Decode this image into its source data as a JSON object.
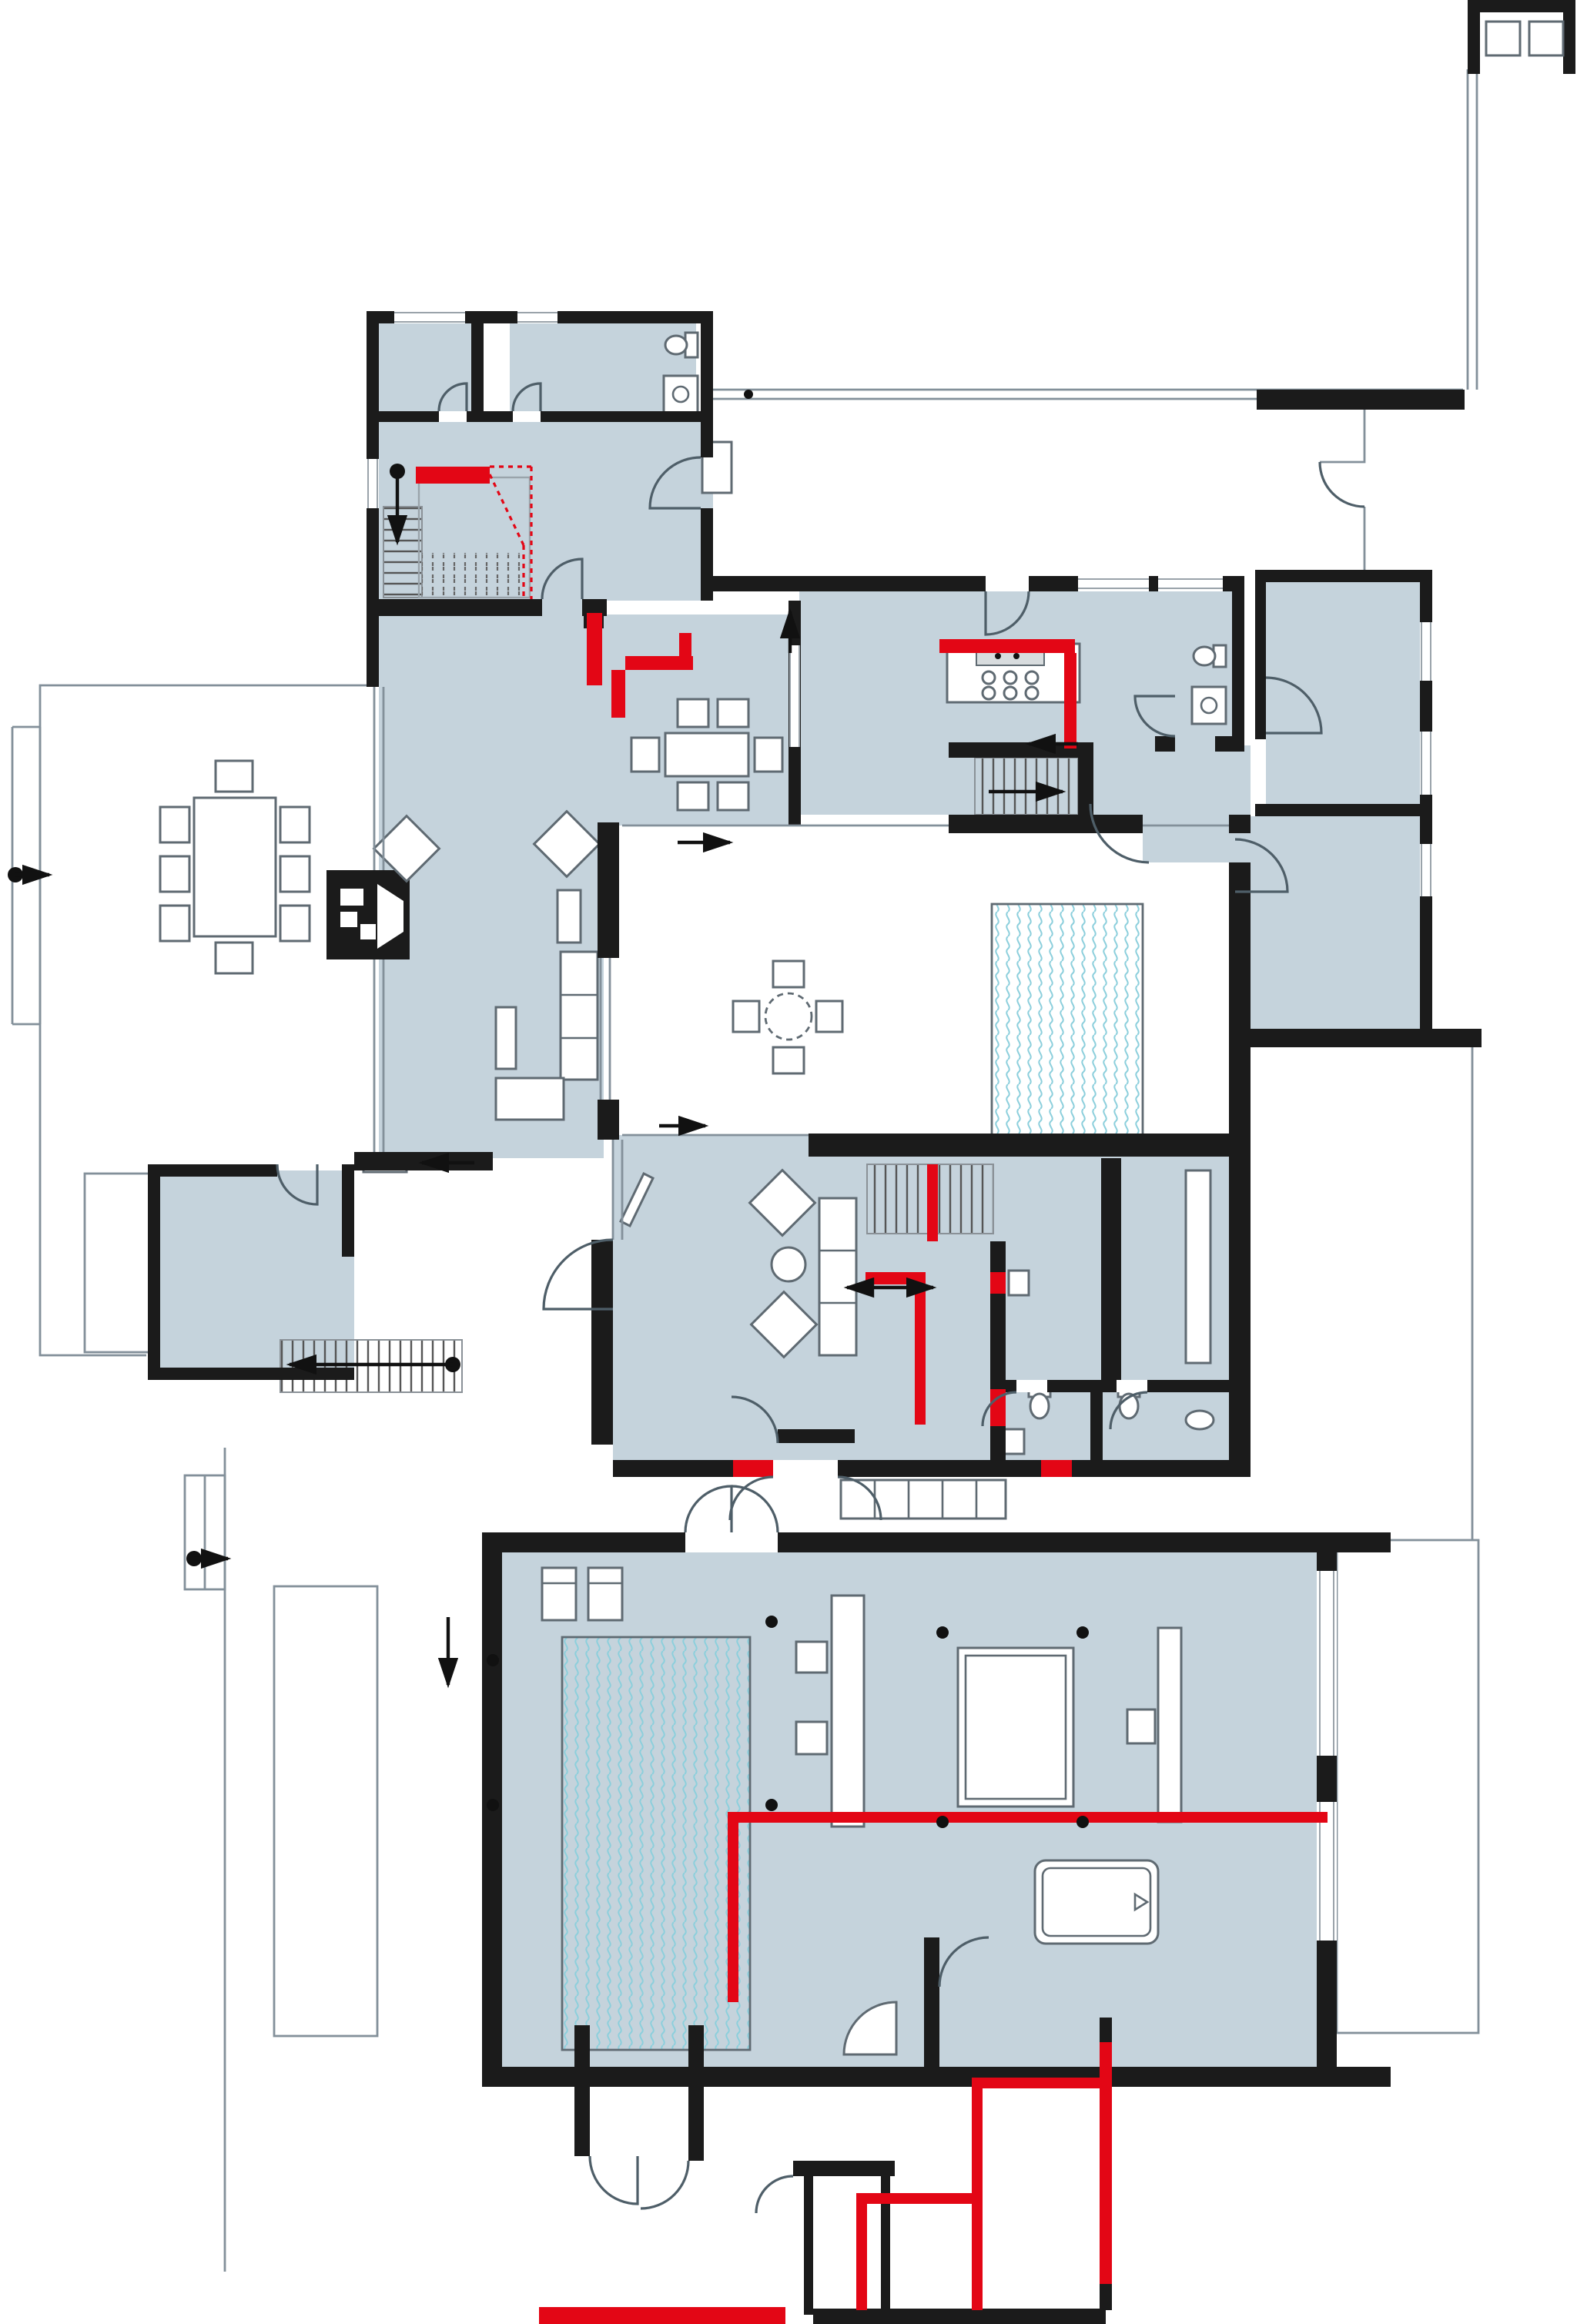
{
  "document": {
    "kind": "architectural floor plan",
    "view": "top-down ground floor plan with furniture",
    "visible_text": ""
  },
  "palette": {
    "background": "#ffffff",
    "room_fill": "#c5d3dc",
    "wall": "#1b1b1b",
    "accent_red": "#e30615",
    "pool_wave": "#8ccfdc",
    "outline": "#83909a",
    "furniture": "#5f6a72",
    "door": "#4e5e68"
  },
  "features": {
    "pools": 2,
    "stair_flights": 4,
    "fireplace": 1,
    "bathtub": 1,
    "toilets": 5,
    "bed": 1,
    "dining_tables": 2,
    "round_tables": 2,
    "rooms_tinted": [
      "bedroom",
      "wc",
      "entrance-hall",
      "kitchen",
      "dining-room",
      "living-room",
      "sitting-area",
      "corridor",
      "wardrobe-room",
      "bathroom",
      "pool-hall",
      "master-bedroom",
      "bath-room"
    ],
    "white_zones": [
      "atrium-courtyard",
      "terraces",
      "carport",
      "entry-porch"
    ],
    "red_markings": "new / altered wall segments and extension outline",
    "flow_arrows": 12
  }
}
